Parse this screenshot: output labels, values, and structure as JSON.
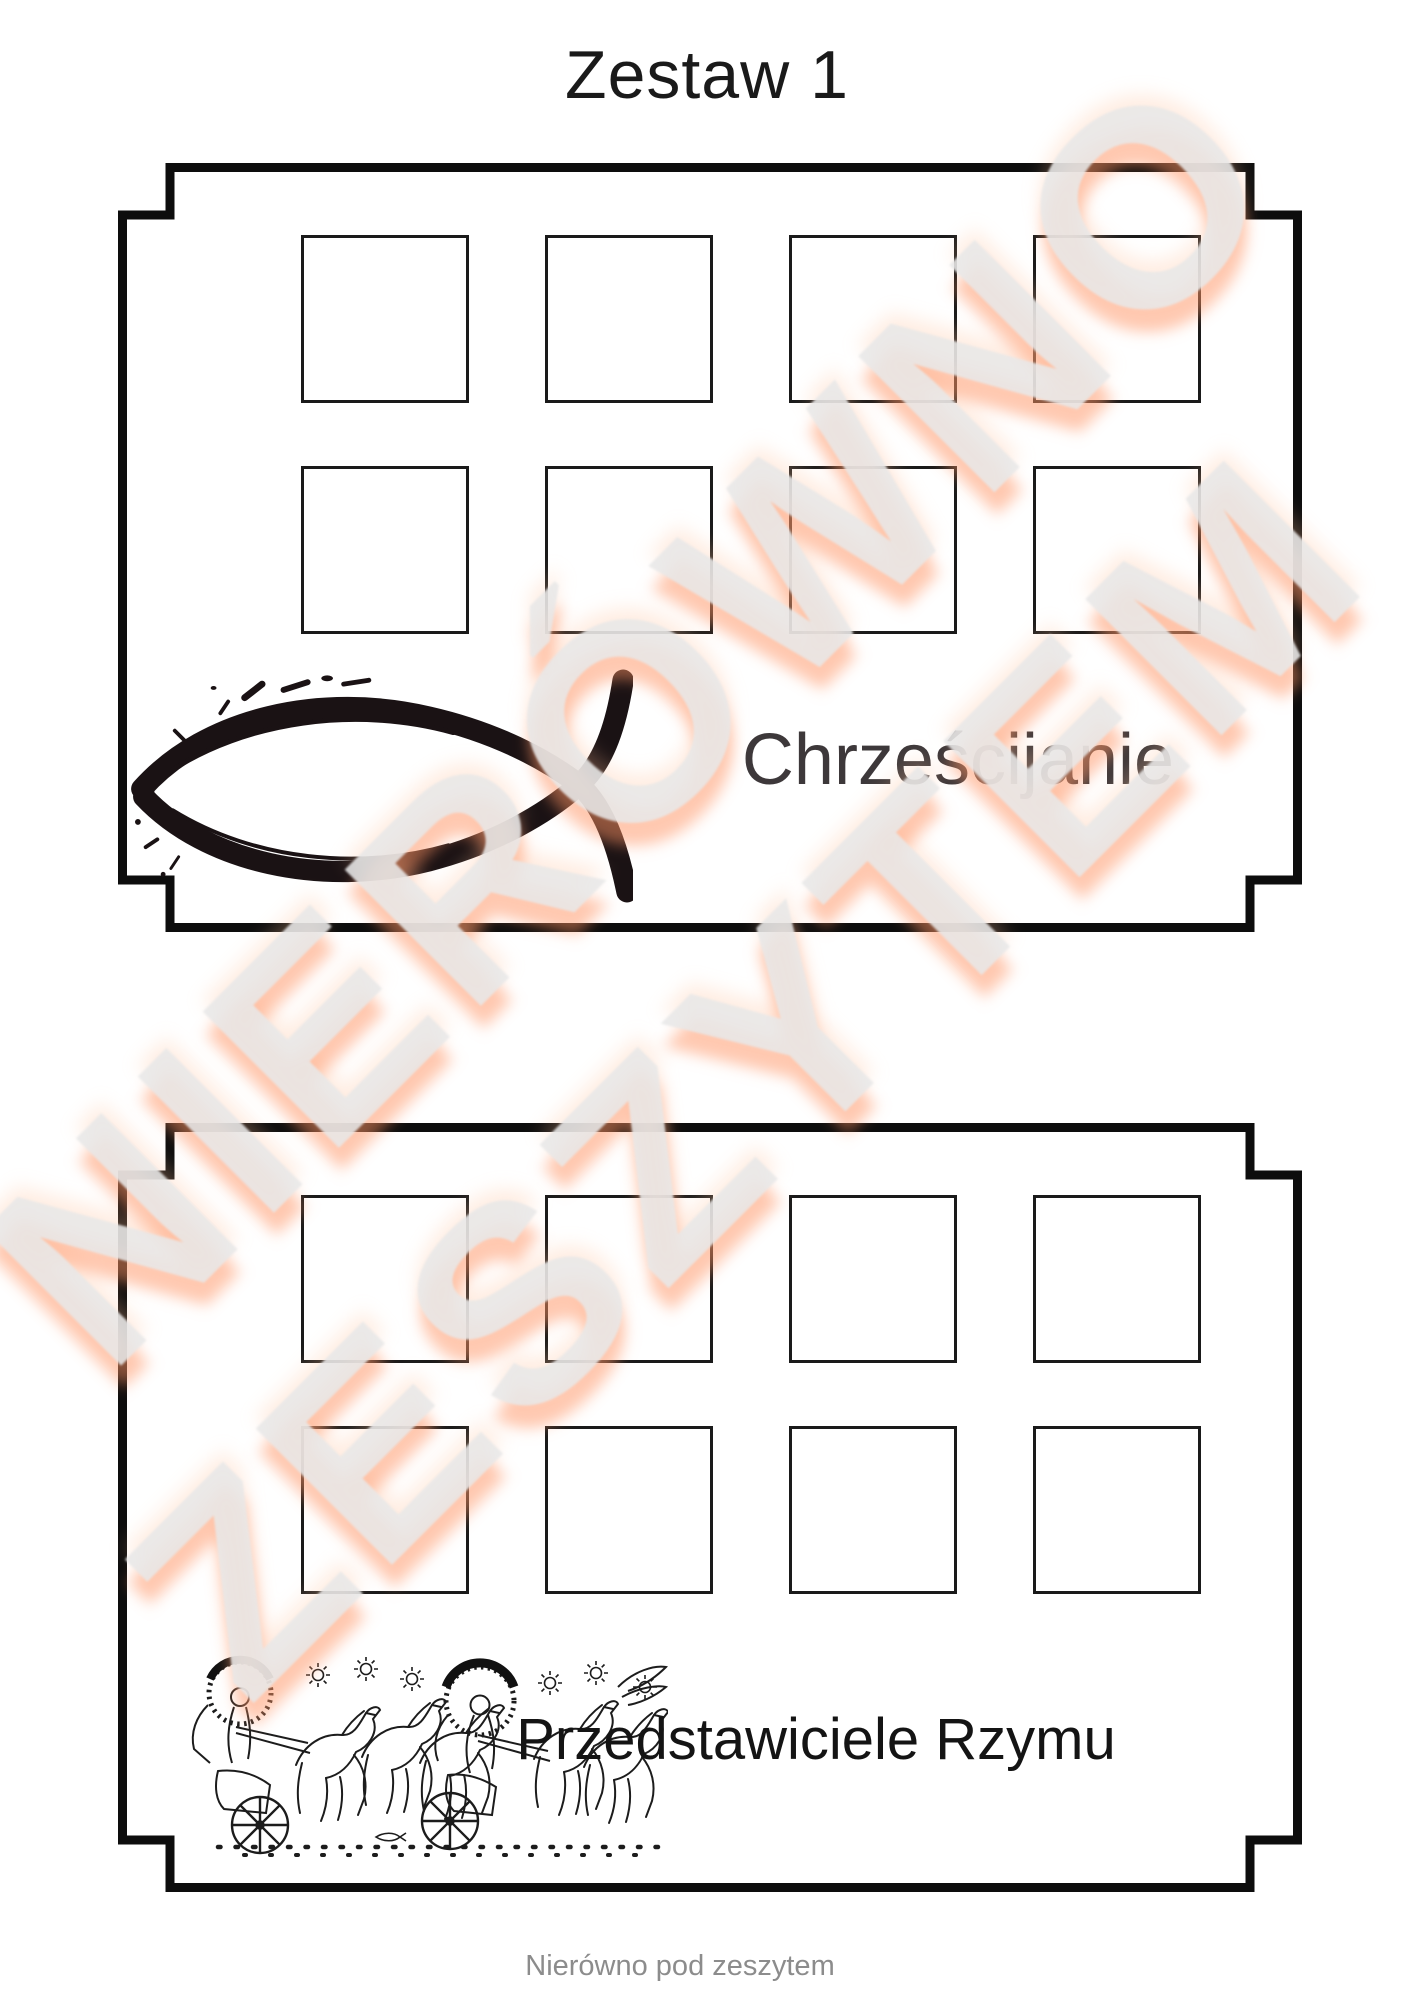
{
  "page": {
    "title": "Zestaw 1",
    "footer": "Nierówno pod zeszytem",
    "background_color": "#ffffff",
    "title_color": "#1a1a1a",
    "footer_color": "#8c8c8c"
  },
  "watermark": {
    "lines": [
      "NIERÓWNO",
      "ZESZYTEM"
    ],
    "color": "#ebebeb",
    "glow_color": "#ffb48c",
    "angle_deg": -45
  },
  "cards": [
    {
      "label": "Chrześcijanie",
      "label_color": "#3d383a",
      "slots": 8,
      "illustration": "ichthys-fish-illustration"
    },
    {
      "label": "Przedstawiciele Rzymu",
      "label_color": "#141414",
      "slots": 8,
      "illustration": "roman-quadriga-illustration"
    }
  ],
  "frame": {
    "card_border_color": "#0d0d0d",
    "slot_border_color": "#1a1a1a",
    "illustration_ink_color": "#1a1214"
  }
}
